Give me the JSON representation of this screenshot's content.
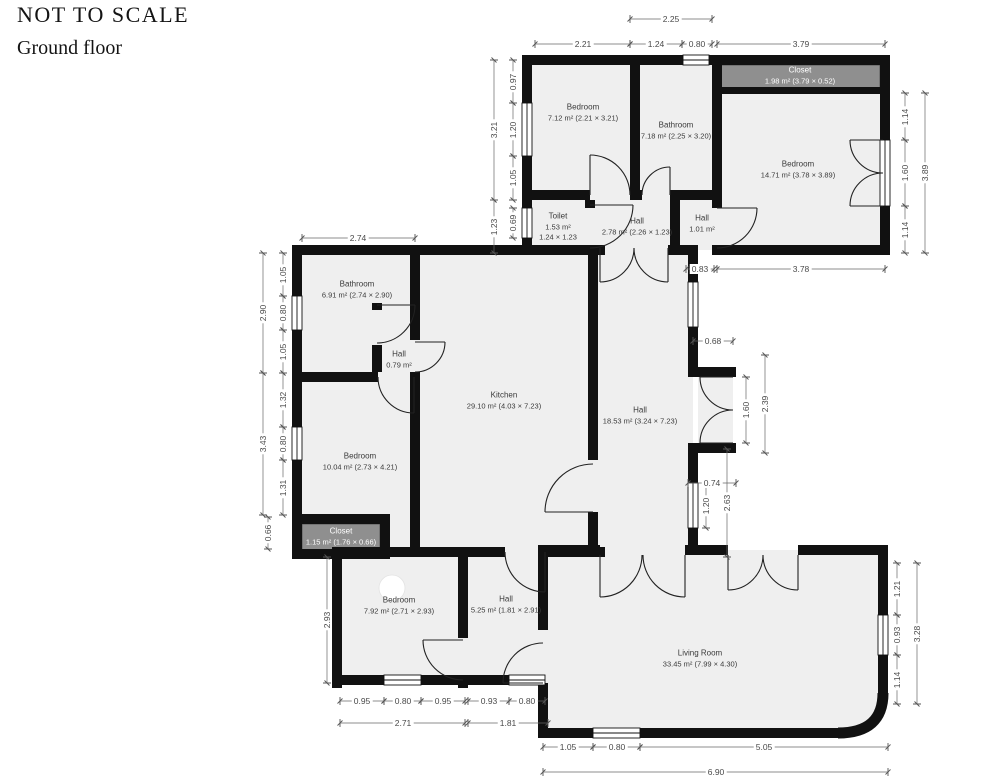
{
  "header": {
    "title": "NOT TO SCALE",
    "floor_label": "Ground floor"
  },
  "colors": {
    "wall": "#111111",
    "floor": "#efefef",
    "closet_fill": "#8f8f8f",
    "dimension_text": "#4a4a4a"
  },
  "rooms": [
    {
      "id": "bedroom-top-left",
      "name": "Bedroom",
      "area": "7.12 m² (2.21 × 3.21)",
      "x": 583,
      "y": 113,
      "closet": false
    },
    {
      "id": "bathroom-top",
      "name": "Bathroom",
      "area": "7.18 m² (2.25 × 3.20)",
      "x": 676,
      "y": 131,
      "closet": false
    },
    {
      "id": "closet-top",
      "name": "Closet",
      "area": "1.98 m² (3.79 × 0.52)",
      "x": 800,
      "y": 76,
      "closet": true
    },
    {
      "id": "bedroom-top-right",
      "name": "Bedroom",
      "area": "14.71 m² (3.78 × 3.89)",
      "x": 798,
      "y": 170,
      "closet": false
    },
    {
      "id": "toilet",
      "name": "Toilet",
      "area": "1.53 m²",
      "size": "1.24 × 1.23",
      "x": 558,
      "y": 227,
      "closet": false
    },
    {
      "id": "hall-top",
      "name": "Hall",
      "area": "2.78 m² (2.26 × 1.23)",
      "x": 637,
      "y": 227,
      "closet": false
    },
    {
      "id": "hall-small",
      "name": "Hall",
      "area": "1.01 m²",
      "x": 702,
      "y": 224,
      "closet": false
    },
    {
      "id": "bathroom-left",
      "name": "Bathroom",
      "area": "6.91 m² (2.74 × 2.90)",
      "x": 357,
      "y": 290,
      "closet": false
    },
    {
      "id": "hall-inner",
      "name": "Hall",
      "area": "0.79 m²",
      "x": 399,
      "y": 360,
      "closet": false
    },
    {
      "id": "kitchen",
      "name": "Kitchen",
      "area": "29.10 m² (4.03 × 7.23)",
      "x": 504,
      "y": 401,
      "closet": false
    },
    {
      "id": "hall-main",
      "name": "Hall",
      "area": "18.53 m² (3.24 × 7.23)",
      "x": 640,
      "y": 416,
      "closet": false
    },
    {
      "id": "bedroom-left",
      "name": "Bedroom",
      "area": "10.04 m² (2.73 × 4.21)",
      "x": 360,
      "y": 462,
      "closet": false
    },
    {
      "id": "closet-left",
      "name": "Closet",
      "area": "1.15 m² (1.76 × 0.66)",
      "x": 341,
      "y": 537,
      "closet": true
    },
    {
      "id": "bedroom-bottom",
      "name": "Bedroom",
      "area": "7.92 m² (2.71 × 2.93)",
      "x": 399,
      "y": 606,
      "closet": false
    },
    {
      "id": "hall-bottom",
      "name": "Hall",
      "area": "5.25 m² (1.81 × 2.91)",
      "x": 506,
      "y": 605,
      "closet": false
    },
    {
      "id": "living-room",
      "name": "Living Room",
      "area": "33.45 m² (7.99 × 4.30)",
      "x": 700,
      "y": 659,
      "closet": false
    }
  ],
  "dimensions": [
    {
      "label": "2.21",
      "x": 583,
      "y": 44,
      "rot": 0
    },
    {
      "label": "2.25",
      "x": 671,
      "y": 19,
      "rot": 0
    },
    {
      "label": "1.24",
      "x": 656,
      "y": 44,
      "rot": 0
    },
    {
      "label": "0.80",
      "x": 697,
      "y": 44,
      "rot": 0
    },
    {
      "label": "3.79",
      "x": 801,
      "y": 44,
      "rot": 0
    },
    {
      "label": "2.74",
      "x": 358,
      "y": 238,
      "rot": 0
    },
    {
      "label": "0.83",
      "x": 700,
      "y": 269,
      "rot": 0
    },
    {
      "label": "3.78",
      "x": 801,
      "y": 269,
      "rot": 0
    },
    {
      "label": "0.68",
      "x": 713,
      "y": 341,
      "rot": 0
    },
    {
      "label": "0.74",
      "x": 712,
      "y": 483,
      "rot": 0
    },
    {
      "label": "0.95",
      "x": 362,
      "y": 701,
      "rot": 0
    },
    {
      "label": "0.80",
      "x": 403,
      "y": 701,
      "rot": 0
    },
    {
      "label": "0.95",
      "x": 443,
      "y": 701,
      "rot": 0
    },
    {
      "label": "2.71",
      "x": 403,
      "y": 723,
      "rot": 0
    },
    {
      "label": "0.93",
      "x": 489,
      "y": 701,
      "rot": 0
    },
    {
      "label": "0.80",
      "x": 527,
      "y": 701,
      "rot": 0
    },
    {
      "label": "1.81",
      "x": 508,
      "y": 723,
      "rot": 0
    },
    {
      "label": "1.05",
      "x": 568,
      "y": 747,
      "rot": 0
    },
    {
      "label": "0.80",
      "x": 617,
      "y": 747,
      "rot": 0
    },
    {
      "label": "5.05",
      "x": 764,
      "y": 747,
      "rot": 0
    },
    {
      "label": "6.90",
      "x": 716,
      "y": 772,
      "rot": 0
    },
    {
      "label": "0.97",
      "x": 513,
      "y": 82,
      "rot": 1
    },
    {
      "label": "1.20",
      "x": 513,
      "y": 130,
      "rot": 1
    },
    {
      "label": "1.05",
      "x": 513,
      "y": 178,
      "rot": 1
    },
    {
      "label": "3.21",
      "x": 494,
      "y": 130,
      "rot": 1
    },
    {
      "label": "1.23",
      "x": 494,
      "y": 227,
      "rot": 1
    },
    {
      "label": "0.69",
      "x": 513,
      "y": 223,
      "rot": 1
    },
    {
      "label": "1.14",
      "x": 905,
      "y": 117,
      "rot": 1
    },
    {
      "label": "1.60",
      "x": 905,
      "y": 173,
      "rot": 1
    },
    {
      "label": "1.14",
      "x": 905,
      "y": 230,
      "rot": 1
    },
    {
      "label": "3.89",
      "x": 925,
      "y": 173,
      "rot": 1
    },
    {
      "label": "1.05",
      "x": 283,
      "y": 275,
      "rot": 1
    },
    {
      "label": "0.80",
      "x": 283,
      "y": 313,
      "rot": 1
    },
    {
      "label": "1.05",
      "x": 283,
      "y": 352,
      "rot": 1
    },
    {
      "label": "2.90",
      "x": 263,
      "y": 313,
      "rot": 1
    },
    {
      "label": "1.32",
      "x": 283,
      "y": 400,
      "rot": 1
    },
    {
      "label": "0.80",
      "x": 283,
      "y": 444,
      "rot": 1
    },
    {
      "label": "1.31",
      "x": 283,
      "y": 488,
      "rot": 1
    },
    {
      "label": "3.43",
      "x": 263,
      "y": 444,
      "rot": 1
    },
    {
      "label": "0.66",
      "x": 268,
      "y": 533,
      "rot": 1
    },
    {
      "label": "2.93",
      "x": 327,
      "y": 620,
      "rot": 1
    },
    {
      "label": "1.60",
      "x": 746,
      "y": 410,
      "rot": 1
    },
    {
      "label": "2.39",
      "x": 765,
      "y": 404,
      "rot": 1
    },
    {
      "label": "1.20",
      "x": 706,
      "y": 506,
      "rot": 1
    },
    {
      "label": "2.63",
      "x": 727,
      "y": 503,
      "rot": 1
    },
    {
      "label": "1.21",
      "x": 897,
      "y": 589,
      "rot": 1
    },
    {
      "label": "0.93",
      "x": 897,
      "y": 635,
      "rot": 1
    },
    {
      "label": "1.14",
      "x": 897,
      "y": 680,
      "rot": 1
    },
    {
      "label": "3.28",
      "x": 917,
      "y": 634,
      "rot": 1
    }
  ]
}
